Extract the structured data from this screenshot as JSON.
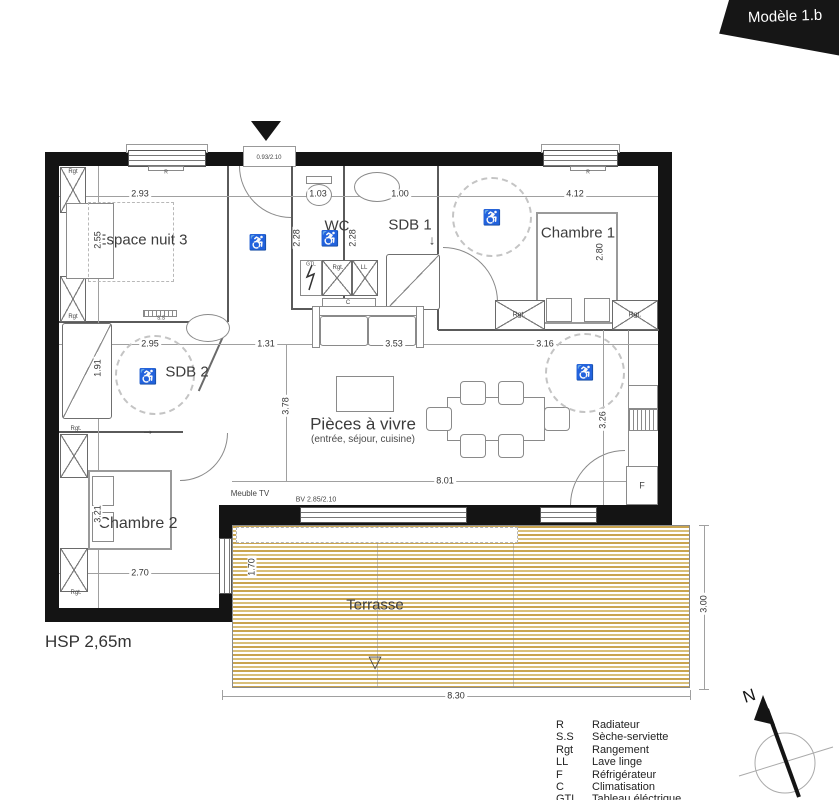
{
  "banner": {
    "title": "Modèle 1.b"
  },
  "plan": {
    "hsp": "HSP 2,65m",
    "rooms": [
      {
        "id": "espace-nuit-3",
        "label": "Espace nuit 3"
      },
      {
        "id": "wc",
        "label": "WC"
      },
      {
        "id": "sdb-1",
        "label": "SDB 1"
      },
      {
        "id": "chambre-1",
        "label": "Chambre 1"
      },
      {
        "id": "sdb-2",
        "label": "SDB 2"
      },
      {
        "id": "pieces-a-vivre",
        "label": "Pièces à vivre",
        "sublabel": "(entrée, séjour, cuisine)"
      },
      {
        "id": "chambre-2",
        "label": "Chambre 2"
      },
      {
        "id": "terrasse",
        "label": "Terrasse"
      }
    ],
    "dimensions": [
      {
        "t": "2.93",
        "x": 140,
        "y": 194,
        "r": 0
      },
      {
        "t": "1.03",
        "x": 318,
        "y": 194,
        "r": 0
      },
      {
        "t": "1.00",
        "x": 400,
        "y": 194,
        "r": 0
      },
      {
        "t": "4.12",
        "x": 575,
        "y": 194,
        "r": 0
      },
      {
        "t": "2.55",
        "x": 98,
        "y": 240,
        "r": 1
      },
      {
        "t": "2.28",
        "x": 297,
        "y": 238,
        "r": 1
      },
      {
        "t": "2.28",
        "x": 353,
        "y": 238,
        "r": 1
      },
      {
        "t": "2.80",
        "x": 600,
        "y": 252,
        "r": 1
      },
      {
        "t": "2.95",
        "x": 150,
        "y": 344,
        "r": 0
      },
      {
        "t": "1.31",
        "x": 266,
        "y": 344,
        "r": 0
      },
      {
        "t": "3.53",
        "x": 394,
        "y": 344,
        "r": 0
      },
      {
        "t": "3.16",
        "x": 545,
        "y": 344,
        "r": 0
      },
      {
        "t": "1.91",
        "x": 98,
        "y": 368,
        "r": 1
      },
      {
        "t": "3.78",
        "x": 286,
        "y": 406,
        "r": 1
      },
      {
        "t": "3.26",
        "x": 603,
        "y": 420,
        "r": 1
      },
      {
        "t": "8.01",
        "x": 445,
        "y": 481,
        "r": 0
      },
      {
        "t": "3.21",
        "x": 98,
        "y": 514,
        "r": 1
      },
      {
        "t": "2.70",
        "x": 140,
        "y": 573,
        "r": 0
      },
      {
        "t": "1.70",
        "x": 252,
        "y": 567,
        "r": 1
      },
      {
        "t": "3.00",
        "x": 704,
        "y": 604,
        "r": 1
      },
      {
        "t": "8.30",
        "x": 456,
        "y": 696,
        "r": 0
      }
    ],
    "tags": [
      {
        "t": "Rgt",
        "x": 73,
        "y": 172,
        "s": 6
      },
      {
        "t": "Rgt",
        "x": 73,
        "y": 317,
        "s": 6
      },
      {
        "t": "Rgt.",
        "x": 338,
        "y": 268,
        "s": 6
      },
      {
        "t": "LL",
        "x": 364,
        "y": 268,
        "s": 6
      },
      {
        "t": "GTL",
        "x": 311,
        "y": 265,
        "s": 5
      },
      {
        "t": "C",
        "x": 348,
        "y": 303,
        "s": 6
      },
      {
        "t": "S.S",
        "x": 161,
        "y": 319,
        "s": 5
      },
      {
        "t": "R",
        "x": 166,
        "y": 173,
        "s": 5
      },
      {
        "t": "R",
        "x": 588,
        "y": 173,
        "s": 5
      },
      {
        "t": "Rgt.",
        "x": 519,
        "y": 315,
        "s": 7
      },
      {
        "t": "Rgt.",
        "x": 635,
        "y": 315,
        "s": 7
      },
      {
        "t": "Rgt.",
        "x": 76,
        "y": 429,
        "s": 6
      },
      {
        "t": "Rgt.",
        "x": 76,
        "y": 593,
        "s": 6
      },
      {
        "t": "F",
        "x": 642,
        "y": 486,
        "s": 9
      },
      {
        "t": "Meuble TV",
        "x": 250,
        "y": 494,
        "s": 8
      },
      {
        "t": "BV 2.85/2.10",
        "x": 316,
        "y": 500,
        "s": 7
      },
      {
        "t": "0.93/2.10",
        "x": 269,
        "y": 158,
        "s": 6
      },
      {
        "t": "→",
        "x": 148,
        "y": 430,
        "s": 13
      },
      {
        "t": "↓",
        "x": 432,
        "y": 240,
        "s": 13
      },
      {
        "t": "▽",
        "x": 375,
        "y": 662,
        "s": 17
      }
    ],
    "wheelchairs": [
      {
        "x": 258,
        "y": 243
      },
      {
        "x": 330,
        "y": 239
      },
      {
        "x": 492,
        "y": 218
      },
      {
        "x": 148,
        "y": 377
      },
      {
        "x": 585,
        "y": 373
      }
    ]
  },
  "legend": {
    "items": [
      {
        "abbr": "R",
        "label": "Radiateur"
      },
      {
        "abbr": "S.S",
        "label": "Sèche-serviette"
      },
      {
        "abbr": "Rgt",
        "label": "Rangement"
      },
      {
        "abbr": "LL",
        "label": "Lave linge"
      },
      {
        "abbr": "F",
        "label": "Réfrigérateur"
      },
      {
        "abbr": "C",
        "label": "Climatisation"
      },
      {
        "abbr": "GTL",
        "label": "Tableau éléctrique"
      }
    ]
  },
  "compass": {
    "north": "N"
  }
}
